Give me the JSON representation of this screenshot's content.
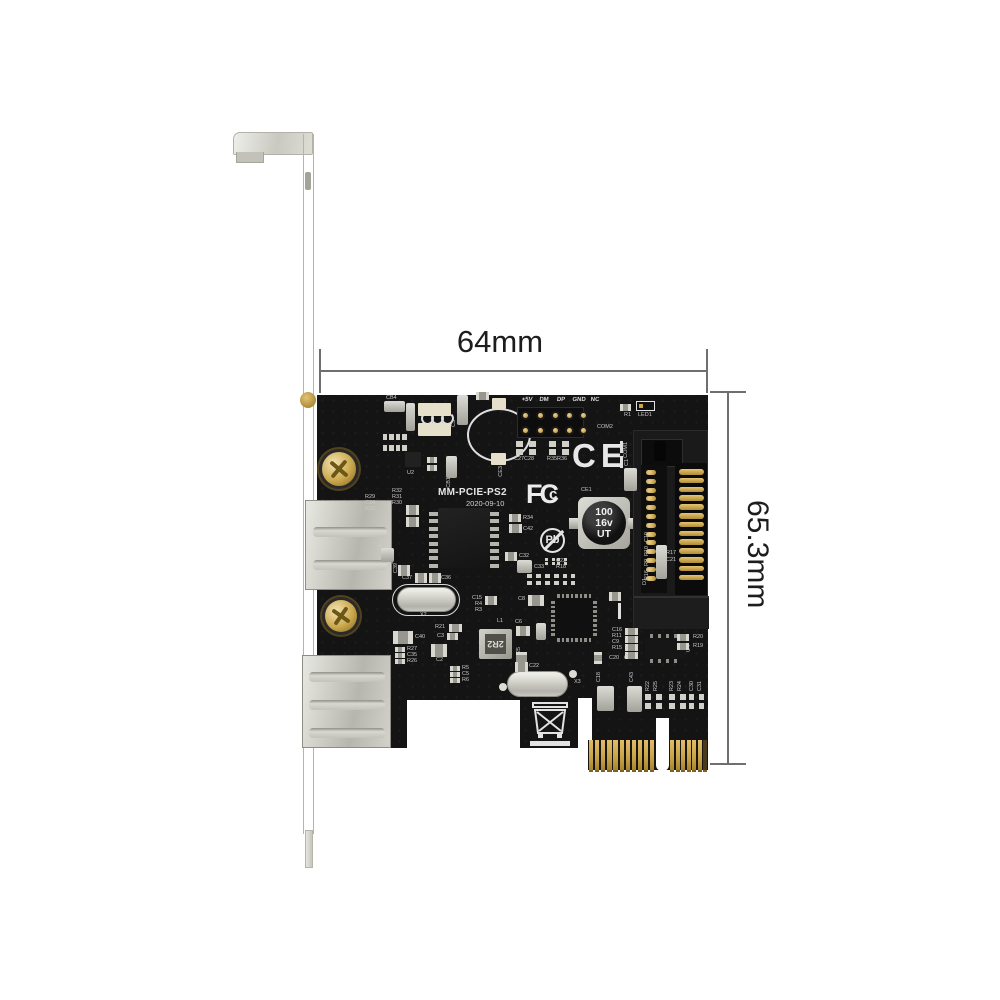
{
  "dims": {
    "width_label": "64mm",
    "height_label": "65.3mm"
  },
  "colors": {
    "pcb": "#141414",
    "gold": "#c9a54a",
    "silk": "#c9c9c9",
    "metal": "#d6d6d0",
    "dim_line": "#6f6f6f"
  },
  "board": {
    "model_silk": "MM-PCIE-PS2",
    "date_silk": "2020-09-10",
    "marks": {
      "ce": "CE",
      "pb": "Pb",
      "fcc": [
        "F",
        "C",
        "c"
      ],
      "cap": [
        "100",
        "16v",
        "UT"
      ],
      "inductor": "2R2"
    },
    "header_labels": [
      "+5V",
      "DM",
      "DP",
      "GND",
      "NC"
    ],
    "header_label_xs": [
      527,
      544,
      561,
      579,
      595
    ],
    "header_pin_xs": [
      523,
      538,
      553,
      567,
      581
    ],
    "header_pin_ys": [
      413,
      428
    ],
    "silk_labels": [
      {
        "t": "CB4",
        "x": 386,
        "y": 396
      },
      {
        "t": "CB3",
        "x": 412,
        "y": 404,
        "v": 1
      },
      {
        "t": "C3",
        "x": 452,
        "y": 420,
        "v": 1
      },
      {
        "t": "CE3",
        "x": 499,
        "y": 466,
        "v": 1
      },
      {
        "t": "U2",
        "x": 407,
        "y": 471
      },
      {
        "t": "CB1",
        "x": 447,
        "y": 477,
        "v": 1
      },
      {
        "t": "R29",
        "x": 365,
        "y": 495
      },
      {
        "t": "C34",
        "x": 365,
        "y": 501
      },
      {
        "t": "R28",
        "x": 365,
        "y": 507
      },
      {
        "t": "R32",
        "x": 392,
        "y": 489
      },
      {
        "t": "R31",
        "x": 392,
        "y": 495
      },
      {
        "t": "R30",
        "x": 392,
        "y": 501
      },
      {
        "t": "C41",
        "x": 379,
        "y": 541,
        "v": 1
      },
      {
        "t": "C39",
        "x": 394,
        "y": 563,
        "v": 1
      },
      {
        "t": "C37",
        "x": 402,
        "y": 576
      },
      {
        "t": "C36",
        "x": 441,
        "y": 576
      },
      {
        "t": "X2",
        "x": 420,
        "y": 613
      },
      {
        "t": "R34",
        "x": 523,
        "y": 516
      },
      {
        "t": "C42",
        "x": 523,
        "y": 527
      },
      {
        "t": "C32",
        "x": 519,
        "y": 554
      },
      {
        "t": "C33",
        "x": 534,
        "y": 565
      },
      {
        "t": "C23",
        "x": 556,
        "y": 559
      },
      {
        "t": "R18",
        "x": 556,
        "y": 565
      },
      {
        "t": "C27",
        "x": 514,
        "y": 457
      },
      {
        "t": "C28",
        "x": 524,
        "y": 457
      },
      {
        "t": "R35",
        "x": 547,
        "y": 457
      },
      {
        "t": "R36",
        "x": 557,
        "y": 457
      },
      {
        "t": "C15",
        "x": 472,
        "y": 596
      },
      {
        "t": "R4",
        "x": 475,
        "y": 602
      },
      {
        "t": "R3",
        "x": 475,
        "y": 608
      },
      {
        "t": "C8",
        "x": 518,
        "y": 597
      },
      {
        "t": "R21",
        "x": 435,
        "y": 625
      },
      {
        "t": "C3",
        "x": 437,
        "y": 634
      },
      {
        "t": "C40",
        "x": 415,
        "y": 635
      },
      {
        "t": "R27",
        "x": 407,
        "y": 647
      },
      {
        "t": "C35",
        "x": 407,
        "y": 653
      },
      {
        "t": "R26",
        "x": 407,
        "y": 659
      },
      {
        "t": "C2",
        "x": 436,
        "y": 658
      },
      {
        "t": "L1",
        "x": 497,
        "y": 619
      },
      {
        "t": "C6",
        "x": 515,
        "y": 620
      },
      {
        "t": "R5",
        "x": 462,
        "y": 666
      },
      {
        "t": "C5",
        "x": 462,
        "y": 672
      },
      {
        "t": "R6",
        "x": 462,
        "y": 678
      },
      {
        "t": "C22",
        "x": 529,
        "y": 664
      },
      {
        "t": "X3",
        "x": 574,
        "y": 680
      },
      {
        "t": "C25",
        "x": 517,
        "y": 647,
        "v": 1
      },
      {
        "t": "C16",
        "x": 612,
        "y": 628
      },
      {
        "t": "R11",
        "x": 612,
        "y": 634
      },
      {
        "t": "C9",
        "x": 612,
        "y": 640
      },
      {
        "t": "R15",
        "x": 612,
        "y": 646
      },
      {
        "t": "C20",
        "x": 609,
        "y": 656
      },
      {
        "t": "C24",
        "x": 624,
        "y": 656
      },
      {
        "t": "R20",
        "x": 693,
        "y": 635
      },
      {
        "t": "R19",
        "x": 693,
        "y": 644
      },
      {
        "t": "U4",
        "x": 687,
        "y": 645,
        "v": 1
      },
      {
        "t": "C18",
        "x": 597,
        "y": 672,
        "v": 1
      },
      {
        "t": "C43",
        "x": 630,
        "y": 672,
        "v": 1
      },
      {
        "t": "R22",
        "x": 646,
        "y": 681,
        "v": 1
      },
      {
        "t": "R25",
        "x": 654,
        "y": 681,
        "v": 1
      },
      {
        "t": "R23",
        "x": 670,
        "y": 681,
        "v": 1
      },
      {
        "t": "R24",
        "x": 678,
        "y": 681,
        "v": 1
      },
      {
        "t": "C30",
        "x": 690,
        "y": 681,
        "v": 1
      },
      {
        "t": "C31",
        "x": 698,
        "y": 681,
        "v": 1
      },
      {
        "t": "COM1",
        "x": 624,
        "y": 442,
        "v": 1
      },
      {
        "t": "C1",
        "x": 625,
        "y": 459,
        "v": 1
      },
      {
        "t": "COM2",
        "x": 597,
        "y": 425
      },
      {
        "t": "D1",
        "x": 643,
        "y": 578,
        "v": 1
      },
      {
        "t": "R17",
        "x": 666,
        "y": 551
      },
      {
        "t": "C21",
        "x": 666,
        "y": 558
      },
      {
        "t": "C10",
        "x": 645,
        "y": 532,
        "v": 1
      },
      {
        "t": "R10",
        "x": 645,
        "y": 546,
        "v": 1
      },
      {
        "t": "R9",
        "x": 645,
        "y": 559,
        "v": 1
      },
      {
        "t": "R16",
        "x": 645,
        "y": 570,
        "v": 1
      },
      {
        "t": "R1",
        "x": 624,
        "y": 413
      },
      {
        "t": "LED1",
        "x": 638,
        "y": 413
      },
      {
        "t": "CE1",
        "x": 581,
        "y": 488
      },
      {
        "t": "J2",
        "x": 390,
        "y": 558,
        "v": 1
      },
      {
        "t": "J4",
        "x": 383,
        "y": 678,
        "v": 1
      }
    ],
    "passives": [
      {
        "x": 384,
        "y": 401,
        "w": 21,
        "h": 11,
        "k": "s"
      },
      {
        "x": 406,
        "y": 403,
        "w": 9,
        "h": 28,
        "k": "s"
      },
      {
        "x": 457,
        "y": 395,
        "w": 11,
        "h": 30,
        "k": "s"
      },
      {
        "x": 476,
        "y": 392,
        "w": 13,
        "h": 8,
        "k": "p"
      },
      {
        "x": 620,
        "y": 404,
        "w": 11,
        "h": 7,
        "k": "p"
      },
      {
        "x": 636,
        "y": 401,
        "w": 19,
        "h": 10,
        "k": "w"
      },
      {
        "x": 418,
        "y": 403,
        "w": 33,
        "h": 13,
        "k": "pad"
      },
      {
        "x": 418,
        "y": 423,
        "w": 33,
        "h": 13,
        "k": "pad"
      },
      {
        "x": 492,
        "y": 398,
        "w": 14,
        "h": 11,
        "k": "pad"
      },
      {
        "x": 491,
        "y": 453,
        "w": 15,
        "h": 12,
        "k": "pad"
      },
      {
        "x": 383,
        "y": 434,
        "w": 24,
        "h": 17,
        "k": "g8"
      },
      {
        "x": 405,
        "y": 452,
        "w": 16,
        "h": 15,
        "k": "sot"
      },
      {
        "x": 427,
        "y": 457,
        "w": 10,
        "h": 6,
        "k": "p"
      },
      {
        "x": 427,
        "y": 465,
        "w": 10,
        "h": 6,
        "k": "p"
      },
      {
        "x": 446,
        "y": 456,
        "w": 11,
        "h": 22,
        "k": "s"
      },
      {
        "x": 406,
        "y": 505,
        "w": 13,
        "h": 10,
        "k": "p"
      },
      {
        "x": 406,
        "y": 517,
        "w": 13,
        "h": 10,
        "k": "p"
      },
      {
        "x": 381,
        "y": 548,
        "w": 13,
        "h": 14,
        "k": "s"
      },
      {
        "x": 398,
        "y": 565,
        "w": 12,
        "h": 11,
        "k": "p"
      },
      {
        "x": 415,
        "y": 573,
        "w": 12,
        "h": 10,
        "k": "p"
      },
      {
        "x": 429,
        "y": 573,
        "w": 12,
        "h": 10,
        "k": "p"
      },
      {
        "x": 509,
        "y": 514,
        "w": 12,
        "h": 8,
        "k": "p"
      },
      {
        "x": 509,
        "y": 524,
        "w": 13,
        "h": 9,
        "k": "p"
      },
      {
        "x": 505,
        "y": 552,
        "w": 12,
        "h": 9,
        "k": "p"
      },
      {
        "x": 517,
        "y": 560,
        "w": 15,
        "h": 13,
        "k": "s"
      },
      {
        "x": 545,
        "y": 558,
        "w": 10,
        "h": 7,
        "k": "g"
      },
      {
        "x": 557,
        "y": 558,
        "w": 10,
        "h": 7,
        "k": "g"
      },
      {
        "x": 527,
        "y": 574,
        "w": 14,
        "h": 11,
        "k": "g"
      },
      {
        "x": 545,
        "y": 574,
        "w": 14,
        "h": 11,
        "k": "g"
      },
      {
        "x": 563,
        "y": 574,
        "w": 12,
        "h": 11,
        "k": "g"
      },
      {
        "x": 485,
        "y": 596,
        "w": 12,
        "h": 9,
        "k": "p"
      },
      {
        "x": 528,
        "y": 595,
        "w": 16,
        "h": 11,
        "k": "p"
      },
      {
        "x": 449,
        "y": 624,
        "w": 13,
        "h": 8,
        "k": "p"
      },
      {
        "x": 447,
        "y": 633,
        "w": 11,
        "h": 7,
        "k": "p"
      },
      {
        "x": 393,
        "y": 631,
        "w": 20,
        "h": 13,
        "k": "p"
      },
      {
        "x": 395,
        "y": 647,
        "w": 10,
        "h": 5,
        "k": "p"
      },
      {
        "x": 395,
        "y": 653,
        "w": 10,
        "h": 5,
        "k": "p"
      },
      {
        "x": 395,
        "y": 659,
        "w": 10,
        "h": 5,
        "k": "p"
      },
      {
        "x": 431,
        "y": 644,
        "w": 16,
        "h": 13,
        "k": "p"
      },
      {
        "x": 516,
        "y": 626,
        "w": 14,
        "h": 10,
        "k": "p"
      },
      {
        "x": 536,
        "y": 623,
        "w": 10,
        "h": 17,
        "k": "s"
      },
      {
        "x": 516,
        "y": 652,
        "w": 11,
        "h": 13,
        "k": "p"
      },
      {
        "x": 515,
        "y": 662,
        "w": 13,
        "h": 10,
        "k": "p"
      },
      {
        "x": 450,
        "y": 666,
        "w": 10,
        "h": 5,
        "k": "p"
      },
      {
        "x": 450,
        "y": 672,
        "w": 10,
        "h": 5,
        "k": "p"
      },
      {
        "x": 450,
        "y": 678,
        "w": 10,
        "h": 5,
        "k": "p"
      },
      {
        "x": 597,
        "y": 686,
        "w": 17,
        "h": 25,
        "k": "s"
      },
      {
        "x": 627,
        "y": 686,
        "w": 15,
        "h": 26,
        "k": "s"
      },
      {
        "x": 645,
        "y": 694,
        "w": 17,
        "h": 15,
        "k": "g"
      },
      {
        "x": 669,
        "y": 694,
        "w": 17,
        "h": 15,
        "k": "g"
      },
      {
        "x": 689,
        "y": 694,
        "w": 15,
        "h": 15,
        "k": "g"
      },
      {
        "x": 625,
        "y": 628,
        "w": 13,
        "h": 7,
        "k": "p"
      },
      {
        "x": 625,
        "y": 636,
        "w": 13,
        "h": 7,
        "k": "p"
      },
      {
        "x": 625,
        "y": 644,
        "w": 13,
        "h": 7,
        "k": "p"
      },
      {
        "x": 625,
        "y": 652,
        "w": 13,
        "h": 7,
        "k": "p"
      },
      {
        "x": 677,
        "y": 634,
        "w": 12,
        "h": 7,
        "k": "p"
      },
      {
        "x": 677,
        "y": 643,
        "w": 12,
        "h": 7,
        "k": "p"
      },
      {
        "x": 609,
        "y": 592,
        "w": 12,
        "h": 9,
        "k": "p"
      },
      {
        "x": 594,
        "y": 652,
        "w": 8,
        "h": 12,
        "k": "p"
      },
      {
        "x": 656,
        "y": 545,
        "w": 11,
        "h": 34,
        "k": "s"
      },
      {
        "x": 624,
        "y": 468,
        "w": 13,
        "h": 23,
        "k": "s"
      },
      {
        "x": 499,
        "y": 683,
        "w": 8,
        "h": 8,
        "k": "d"
      },
      {
        "x": 569,
        "y": 670,
        "w": 8,
        "h": 8,
        "k": "d"
      },
      {
        "x": 516,
        "y": 441,
        "w": 20,
        "h": 14,
        "k": "g"
      },
      {
        "x": 549,
        "y": 441,
        "w": 20,
        "h": 14,
        "k": "g"
      }
    ],
    "pcie": {
      "y": 740,
      "h": 30,
      "groups": [
        {
          "x": 589,
          "n": 11,
          "step": 6.1,
          "w": 4.3
        },
        {
          "x": 670,
          "n": 7,
          "step": 5.55,
          "w": 4.1
        }
      ]
    },
    "sata": {
      "n": 13,
      "y": 469,
      "step": 8.8
    }
  }
}
